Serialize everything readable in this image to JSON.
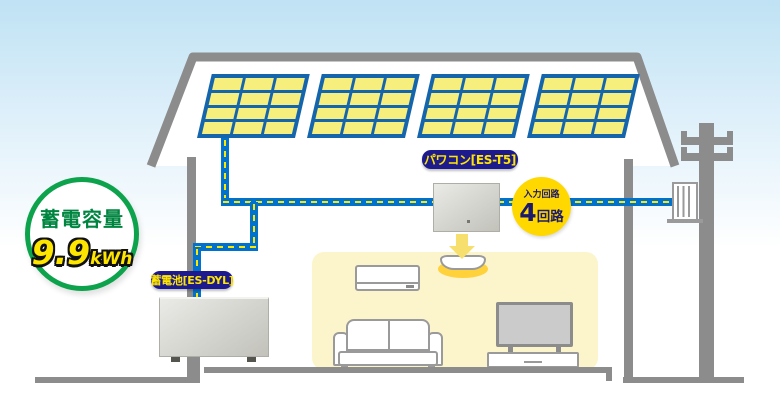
{
  "capacity_badge": {
    "title": "蓄電容量",
    "value": "9.9",
    "unit": "kWh"
  },
  "battery_label": "蓄電池[ES-DYL]",
  "inverter_label": "パワコン[ES-T5]",
  "circuit_badge": {
    "caption": "入力回路",
    "number": "4",
    "unit": "回路"
  },
  "solar": {
    "panel_count": 4,
    "cols": 3,
    "rows": 4
  },
  "colors": {
    "wire": "#0072ce",
    "wire_dash": "#ffe800",
    "panel_frame": "#1565ad",
    "panel_cell": "#f6ee7d",
    "label_bg": "#1d1a8e",
    "label_text": "#ffe600",
    "badge_green": "#0da24c",
    "badge_green_text": "#008540",
    "capacity_value": "#ffe600",
    "circuit_bg": "#ffd800",
    "circuit_text": "#1c1a6d",
    "structure": "#8c8c8c",
    "room_bg": "#fcf5cc",
    "light_glow": "#ffd23c"
  }
}
